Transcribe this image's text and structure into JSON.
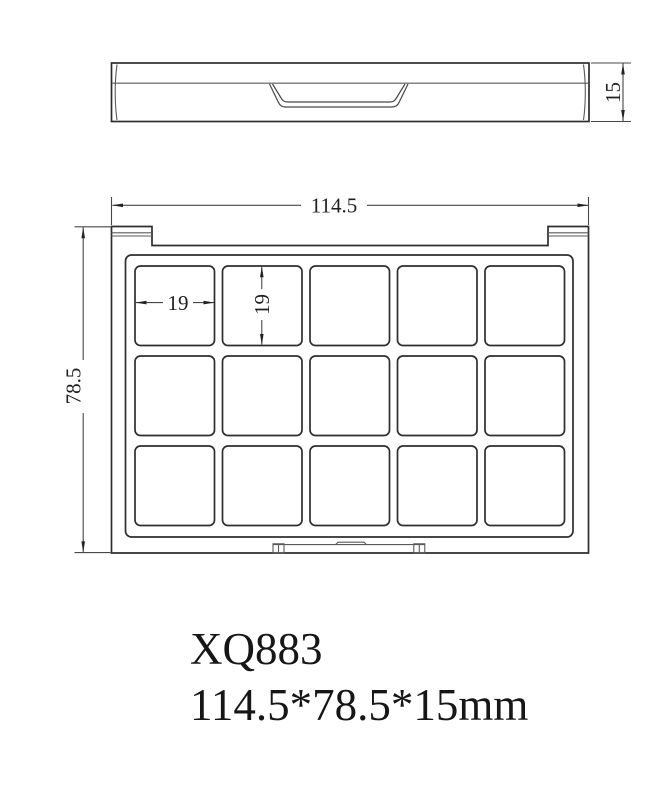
{
  "drawing": {
    "background": "#ffffff",
    "outline_color": "#2e2e2e",
    "thin_line_color": "#5a5a5a",
    "dimension_line_color": "#474747",
    "text_color": "#1f1f1f"
  },
  "dimensions": {
    "overall_width": "114.5",
    "overall_height": "78.5",
    "thickness": "15",
    "well_width": "19",
    "well_height": "19"
  },
  "wells": {
    "rows": 3,
    "columns": 5,
    "count": 15
  },
  "caption": {
    "model": "XQ883",
    "size_text": "114.5*78.5*15mm"
  }
}
